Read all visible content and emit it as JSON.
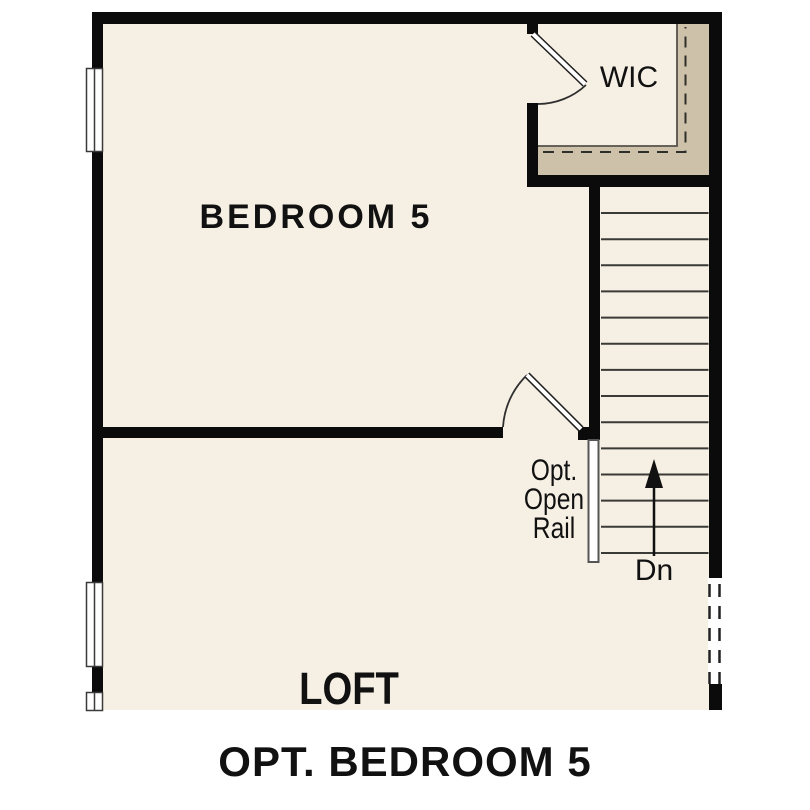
{
  "title": "OPT. BEDROOM 5",
  "rooms": {
    "bedroom": {
      "label": "BEDROOM 5"
    },
    "closet": {
      "label": "WIC"
    },
    "loft": {
      "label": "LOFT"
    }
  },
  "stairs": {
    "direction_label": "Dn",
    "tread_count": 14,
    "railing_note": "Opt.\nOpen\nRail"
  },
  "colors": {
    "page": "#ffffff",
    "floor": "#f6efe3",
    "shelf": "#cdc2a9",
    "wall": "#0b0b0b",
    "line": "#3a3a36",
    "text": "#111111"
  }
}
